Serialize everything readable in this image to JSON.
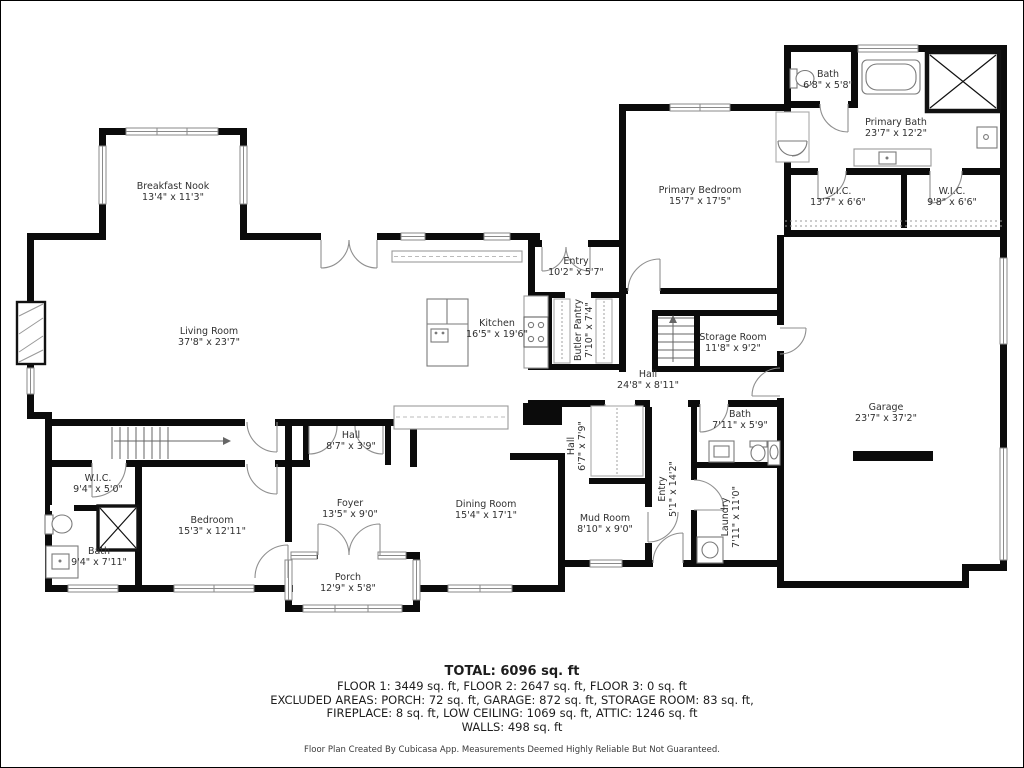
{
  "plan": {
    "rooms": [
      {
        "id": "breakfast-nook",
        "name": "Breakfast Nook",
        "dims": "13'4\" x 11'3\"",
        "x": 173,
        "y": 192,
        "rot": 0
      },
      {
        "id": "living-room",
        "name": "Living Room",
        "dims": "37'8\" x 23'7\"",
        "x": 209,
        "y": 337,
        "rot": 0
      },
      {
        "id": "kitchen",
        "name": "Kitchen",
        "dims": "16'5\" x 19'6\"",
        "x": 497,
        "y": 329,
        "rot": 0
      },
      {
        "id": "entry-main",
        "name": "Entry",
        "dims": "10'2\" x 5'7\"",
        "x": 576,
        "y": 267,
        "rot": 0
      },
      {
        "id": "butler-pantry",
        "name": "Butler Pantry",
        "dims": "7'10\" x 7'4\"",
        "x": 584,
        "y": 330,
        "rot": -90
      },
      {
        "id": "hall-main",
        "name": "Hall",
        "dims": "24'8\" x 8'11\"",
        "x": 648,
        "y": 380,
        "rot": 0
      },
      {
        "id": "storage-room",
        "name": "Storage Room",
        "dims": "11'8\" x 9'2\"",
        "x": 733,
        "y": 343,
        "rot": 0
      },
      {
        "id": "primary-bedroom",
        "name": "Primary Bedroom",
        "dims": "15'7\" x 17'5\"",
        "x": 700,
        "y": 196,
        "rot": 0
      },
      {
        "id": "bath-upper",
        "name": "Bath",
        "dims": "6'8\" x 5'8\"",
        "x": 828,
        "y": 80,
        "rot": 0
      },
      {
        "id": "primary-bath",
        "name": "Primary Bath",
        "dims": "23'7\" x 12'2\"",
        "x": 896,
        "y": 128,
        "rot": 0
      },
      {
        "id": "wic-left",
        "name": "W.I.C.",
        "dims": "13'7\" x 6'6\"",
        "x": 838,
        "y": 197,
        "rot": 0
      },
      {
        "id": "wic-right",
        "name": "W.I.C.",
        "dims": "9'8\" x 6'6\"",
        "x": 952,
        "y": 197,
        "rot": 0
      },
      {
        "id": "garage",
        "name": "Garage",
        "dims": "23'7\" x 37'2\"",
        "x": 886,
        "y": 413,
        "rot": 0
      },
      {
        "id": "bath-middle",
        "name": "Bath",
        "dims": "7'11\" x 5'9\"",
        "x": 740,
        "y": 420,
        "rot": 0
      },
      {
        "id": "laundry",
        "name": "Laundry",
        "dims": "7'11\" x 11'0\"",
        "x": 731,
        "y": 517,
        "rot": -90
      },
      {
        "id": "hall-small",
        "name": "Hall",
        "dims": "6'7\" x 7'9\"",
        "x": 577,
        "y": 446,
        "rot": -90
      },
      {
        "id": "entry-front",
        "name": "Entry",
        "dims": "5'1\" x 14'2\"",
        "x": 668,
        "y": 489,
        "rot": -90
      },
      {
        "id": "mud-room",
        "name": "Mud Room",
        "dims": "8'10\" x 9'0\"",
        "x": 605,
        "y": 524,
        "rot": 0
      },
      {
        "id": "wic-bedroom",
        "name": "W.I.C.",
        "dims": "9'4\" x 5'0\"",
        "x": 98,
        "y": 484,
        "rot": 0
      },
      {
        "id": "bedroom",
        "name": "Bedroom",
        "dims": "15'3\" x 12'11\"",
        "x": 212,
        "y": 526,
        "rot": 0
      },
      {
        "id": "bath-lower",
        "name": "Bath",
        "dims": "9'4\" x 7'11\"",
        "x": 99,
        "y": 557,
        "rot": 0
      },
      {
        "id": "foyer",
        "name": "Foyer",
        "dims": "13'5\" x 9'0\"",
        "x": 350,
        "y": 509,
        "rot": 0
      },
      {
        "id": "porch",
        "name": "Porch",
        "dims": "12'9\" x 5'8\"",
        "x": 348,
        "y": 583,
        "rot": 0
      },
      {
        "id": "hall-foyer",
        "name": "Hall",
        "dims": "8'7\" x 3'9\"",
        "x": 351,
        "y": 441,
        "rot": 0
      },
      {
        "id": "dining-room",
        "name": "Dining Room",
        "dims": "15'4\" x 17'1\"",
        "x": 486,
        "y": 510,
        "rot": 0
      }
    ]
  },
  "footer": {
    "total": "TOTAL: 6096 sq. ft",
    "line1": "FLOOR 1: 3449 sq. ft, FLOOR 2: 2647 sq. ft, FLOOR 3: 0 sq. ft",
    "line2": "EXCLUDED AREAS: PORCH: 72 sq. ft, GARAGE: 872 sq. ft, STORAGE ROOM: 83 sq. ft,",
    "line3": "FIREPLACE: 8 sq. ft, LOW CEILING: 1069 sq. ft, ATTIC: 1246 sq. ft",
    "line4": "WALLS: 498 sq. ft",
    "disclaimer": "Floor Plan Created By Cubicasa App. Measurements Deemed Highly Reliable But Not Guaranteed."
  }
}
